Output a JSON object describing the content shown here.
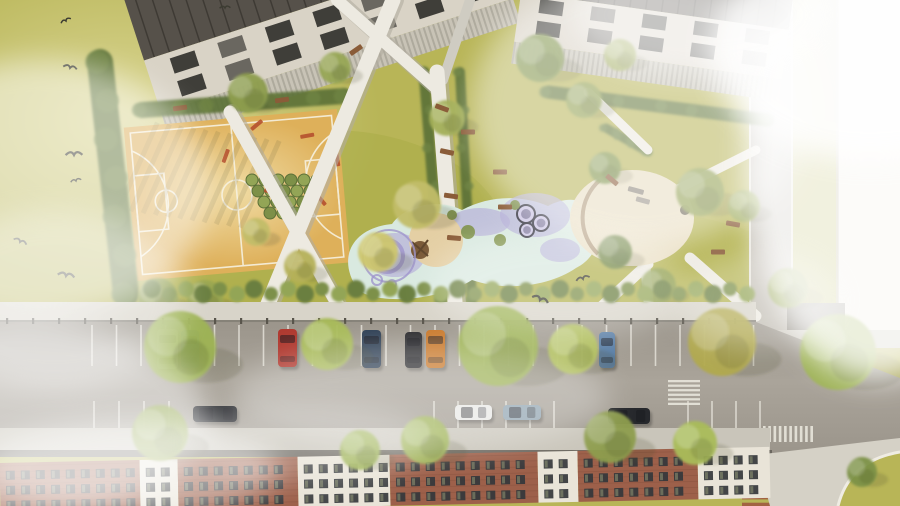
{
  "meta": {
    "title": "Aerial architectural rendering of residential courtyard park with playground, basketball court and street parking",
    "type": "architectural-visualization-top-view"
  },
  "palette": {
    "grass": "#b8b557",
    "grassLight": "#d6d193",
    "grassDark": "#9aa03f",
    "path": "#edeae1",
    "pathShadow": "#b2ada0",
    "court": "#deb05a",
    "courtLight": "#f0dda6",
    "courtLine": "#f6f1e0",
    "hedge": "#5d7239",
    "roof": "#56514a",
    "wall": "#d9d3c6",
    "win": "#2e2d29",
    "terrace": "#c8c3b6",
    "road": "#a6a096",
    "roadDark": "#8f8a81",
    "sidewalk": "#d8d4c9",
    "sidewalkB": "#c9c5ba",
    "fence": "#59554c",
    "stall": "#e8e5dc",
    "mint": "#d9e9e0",
    "lavender": "#b7b0d9",
    "lavenderDark": "#9f95cc",
    "sand": "#e4cfa4",
    "cream": "#e9dec2",
    "brick": "#9d604a",
    "facadeWhite": "#e9e4d8",
    "facadeWin": "#34373b",
    "bench": "#8a5c38",
    "equipment": "#b5502e",
    "bird": "#3c3c32",
    "fog": "#ffffff",
    "treeShadow": "#44482a"
  },
  "scene": {
    "hedges": [
      [
        100,
        62,
        126,
        294,
        26
      ],
      [
        142,
        110,
        344,
        96,
        16
      ],
      [
        424,
        72,
        442,
        300,
        11
      ],
      [
        460,
        72,
        472,
        300,
        10
      ],
      [
        548,
        92,
        768,
        120,
        13
      ],
      [
        606,
        128,
        648,
        152,
        9
      ]
    ],
    "trees_park": [
      [
        248,
        93,
        20,
        "#8d9d4e"
      ],
      [
        335,
        68,
        16,
        "#97a755"
      ],
      [
        447,
        118,
        18,
        "#a3af58"
      ],
      [
        540,
        58,
        24,
        "#7c9147"
      ],
      [
        584,
        100,
        18,
        "#8d9d4e"
      ],
      [
        620,
        55,
        16,
        "#9aa751"
      ],
      [
        417,
        205,
        24,
        "#c2bd68"
      ],
      [
        378,
        252,
        20,
        "#cdc66e"
      ],
      [
        300,
        266,
        16,
        "#b5b159"
      ],
      [
        256,
        232,
        14,
        "#c2bd68"
      ],
      [
        205,
        298,
        18,
        "#9aa751"
      ],
      [
        158,
        298,
        20,
        "#8d9d4e"
      ],
      [
        605,
        168,
        16,
        "#7c9147"
      ],
      [
        700,
        192,
        24,
        "#8d9d4e"
      ],
      [
        744,
        206,
        16,
        "#97a755"
      ],
      [
        658,
        286,
        18,
        "#8d9d4e"
      ],
      [
        788,
        288,
        20,
        "#97a755"
      ],
      [
        615,
        252,
        17,
        "#6d8342"
      ]
    ],
    "trees_road": [
      [
        180,
        347,
        36,
        "#9db353"
      ],
      [
        327,
        344,
        26,
        "#a9bc5a"
      ],
      [
        498,
        346,
        40,
        "#9db353"
      ],
      [
        573,
        349,
        25,
        "#b2c15e"
      ],
      [
        722,
        342,
        34,
        "#b1a94e"
      ],
      [
        838,
        352,
        38,
        "#9db353"
      ],
      [
        160,
        433,
        28,
        "#93a84e"
      ],
      [
        425,
        440,
        24,
        "#9db353"
      ],
      [
        610,
        437,
        26,
        "#8d9d4e"
      ],
      [
        360,
        450,
        20,
        "#9db353"
      ],
      [
        695,
        443,
        22,
        "#a9bc5a"
      ],
      [
        862,
        472,
        15,
        "#7c9147"
      ]
    ],
    "cars": [
      {
        "x": 157,
        "y": 329,
        "w": 21,
        "h": 40,
        "color": "#d4d4d2"
      },
      {
        "x": 181,
        "y": 330,
        "w": 18,
        "h": 38,
        "color": "#4a6e96"
      },
      {
        "x": 278,
        "y": 329,
        "w": 19,
        "h": 38,
        "color": "#b03a30"
      },
      {
        "x": 362,
        "y": 330,
        "w": 19,
        "h": 38,
        "color": "#2e3f54"
      },
      {
        "x": 405,
        "y": 332,
        "w": 17,
        "h": 36,
        "color": "#2b2b2e"
      },
      {
        "x": 426,
        "y": 330,
        "w": 19,
        "h": 38,
        "color": "#c8782a"
      },
      {
        "x": 599,
        "y": 332,
        "w": 16,
        "h": 36,
        "color": "#5b7fa6"
      },
      {
        "x": 193,
        "y": 406,
        "w": 44,
        "h": 16,
        "color": "#1f2125",
        "horizontal": true
      },
      {
        "x": 455,
        "y": 405,
        "w": 37,
        "h": 15,
        "color": "#e8e8e6",
        "horizontal": true
      },
      {
        "x": 503,
        "y": 405,
        "w": 38,
        "h": 15,
        "color": "#8fa3b0",
        "horizontal": true
      },
      {
        "x": 608,
        "y": 408,
        "w": 42,
        "h": 16,
        "color": "#26282c",
        "horizontal": true
      }
    ],
    "birds": [
      [
        66,
        21
      ],
      [
        70,
        68
      ],
      [
        74,
        155
      ],
      [
        76,
        181
      ],
      [
        20,
        242
      ],
      [
        66,
        276
      ],
      [
        225,
        8
      ],
      [
        583,
        279
      ],
      [
        540,
        300
      ]
    ],
    "stall_rows": [
      {
        "x0": 92,
        "step": 24.5,
        "count": 28,
        "y": 325,
        "h": 41
      },
      {
        "x0": 94,
        "step": 25,
        "count": 4,
        "y": 401,
        "h": 28
      },
      {
        "x0": 434,
        "step": 24,
        "count": 6,
        "y": 401,
        "h": 28
      },
      {
        "x0": 688,
        "step": 24,
        "count": 4,
        "y": 401,
        "h": 28
      }
    ],
    "fence": {
      "x0": 0,
      "x1": 756,
      "y": 321,
      "step": 26
    },
    "bush_row": {
      "x0": 152,
      "x1": 752,
      "step": 17,
      "y": 291
    },
    "benches": [
      [
        442,
        108,
        20
      ],
      [
        447,
        152,
        12
      ],
      [
        451,
        196,
        8
      ],
      [
        454,
        238,
        5
      ],
      [
        500,
        172,
        0
      ],
      [
        505,
        207,
        0
      ],
      [
        468,
        132,
        0
      ],
      [
        612,
        180,
        40
      ],
      [
        180,
        108,
        -8
      ],
      [
        282,
        100,
        -8
      ],
      [
        356,
        50,
        -35
      ],
      [
        718,
        252,
        0
      ],
      [
        733,
        224,
        10
      ]
    ],
    "shrub_grid": {
      "x0": 252,
      "y0": 180,
      "cols": 6,
      "rows": 4,
      "dx": 13,
      "dy": 11,
      "r": 6
    },
    "equipment": [
      [
        250,
        128
      ],
      [
        300,
        135
      ],
      [
        265,
        188
      ],
      [
        318,
        193
      ],
      [
        338,
        152
      ],
      [
        230,
        150
      ]
    ],
    "court_shadow_stripes": {
      "x0": 138,
      "count": 11,
      "step": 13
    },
    "building_a_windows": {
      "x0": 175,
      "step": 50,
      "count": 7,
      "w": 26,
      "rows": [
        [
          18,
          16
        ],
        [
          42,
          16
        ]
      ]
    },
    "building_b_windows": {
      "x0": 535,
      "step": 52,
      "count": 5,
      "w": 24,
      "rows": [
        [
          14,
          14
        ],
        [
          36,
          14
        ]
      ]
    },
    "trampolines": [
      [
        526,
        214,
        9
      ],
      [
        541,
        223,
        8
      ],
      [
        527,
        230,
        7
      ]
    ],
    "lavender_blobs": [
      [
        480,
        222,
        30,
        14
      ],
      [
        535,
        215,
        35,
        22
      ],
      [
        395,
        255,
        30,
        22
      ],
      [
        560,
        250,
        20,
        12
      ]
    ],
    "rings": [
      [
        387,
        256,
        16,
        4
      ],
      [
        389,
        256,
        26,
        2
      ],
      [
        377,
        280,
        5,
        2
      ],
      [
        392,
        284,
        4,
        2
      ]
    ],
    "green_tufts": [
      [
        468,
        232,
        7
      ],
      [
        500,
        240,
        6
      ],
      [
        515,
        205,
        5
      ],
      [
        452,
        215,
        5
      ]
    ],
    "crosswalks": [
      {
        "x": 668,
        "y": 380,
        "w": 32,
        "h": 25,
        "dir": "h",
        "stripes": 6,
        "color": "#e8e5dc"
      },
      {
        "x": 763,
        "y": 426,
        "w": 50,
        "h": 16,
        "dir": "v",
        "stripes": 10,
        "color": "#e8e5dc"
      },
      {
        "x": 742,
        "y": 463,
        "w": 38,
        "h": 43,
        "dir": "h",
        "stripes": 7,
        "color": "#a05a40"
      }
    ],
    "facade_segments": [
      {
        "x": 0,
        "w": 140,
        "style": "brick"
      },
      {
        "x": 140,
        "w": 38,
        "style": "white"
      },
      {
        "x": 178,
        "w": 120,
        "style": "brick"
      },
      {
        "x": 298,
        "w": 92,
        "style": "white"
      },
      {
        "x": 390,
        "w": 148,
        "style": "brick"
      },
      {
        "x": 538,
        "w": 40,
        "style": "white"
      },
      {
        "x": 578,
        "w": 120,
        "style": "brick"
      },
      {
        "x": 698,
        "w": 72,
        "style": "white"
      }
    ],
    "facade_window_rows": [
      463,
      478,
      493
    ],
    "fog_patches": [
      [
        40,
        190,
        170,
        130,
        0.5
      ],
      [
        10,
        420,
        200,
        100,
        0.5
      ],
      [
        640,
        110,
        170,
        140,
        0.45
      ],
      [
        560,
        285,
        130,
        55,
        0.3
      ],
      [
        875,
        160,
        130,
        220,
        0.8
      ],
      [
        870,
        50,
        160,
        110,
        0.85
      ],
      [
        420,
        398,
        190,
        55,
        0.3
      ],
      [
        130,
        468,
        150,
        48,
        0.5
      ],
      [
        310,
        442,
        120,
        40,
        0.25
      ],
      [
        700,
        15,
        130,
        60,
        0.45
      ],
      [
        55,
        300,
        130,
        90,
        0.35
      ],
      [
        760,
        300,
        80,
        50,
        0.3
      ]
    ]
  }
}
